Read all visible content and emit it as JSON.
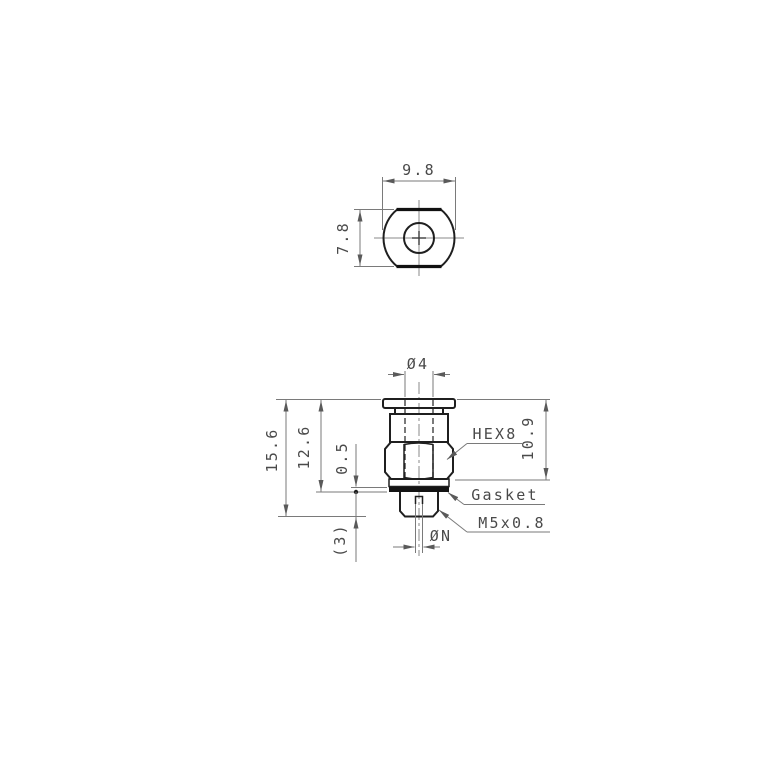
{
  "top_view": {
    "width_dim": "9.8",
    "height_dim": "7.8"
  },
  "front_view": {
    "tube_diameter_dim": "Ø4",
    "overall_height_dim": "15.6",
    "height_to_gasket_dim": "12.6",
    "body_height_dim": "10.9",
    "gasket_thickness_dim": "0.5",
    "thread_length_dim": "(3)",
    "orifice_diameter_dim": "ØN",
    "hex_label": "HEX8",
    "gasket_label": "Gasket",
    "thread_label": "M5x0.8"
  },
  "colors": {
    "background": "#ffffff",
    "outline": "#1f1f1f",
    "dimension_lines": "#7a7a7a",
    "text": "#4a4a4a",
    "gasket_fill": "#141414"
  }
}
